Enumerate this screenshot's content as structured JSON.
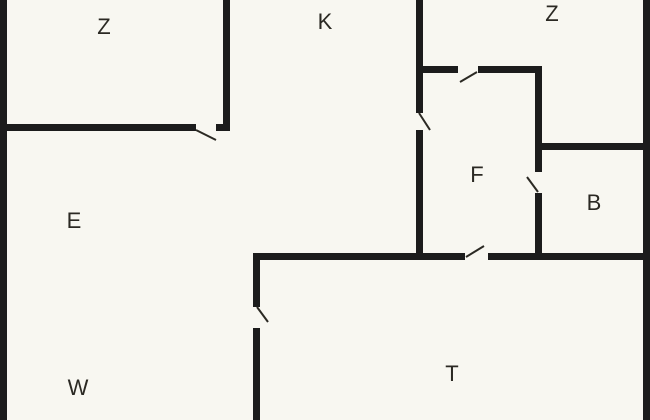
{
  "floorplan": {
    "canvas": {
      "width": 650,
      "height": 420,
      "background": "#f8f7f1"
    },
    "style": {
      "wall_color": "#1c1c1c",
      "wall_thickness": 7,
      "door_line_color": "#2b2923",
      "door_line_width": 2,
      "label_color": "#2b2923",
      "label_font_size": 22
    },
    "room_labels": [
      {
        "id": "room-z-left",
        "text": "Z",
        "cx": 104,
        "cy": 27
      },
      {
        "id": "room-k",
        "text": "K",
        "cx": 325,
        "cy": 22
      },
      {
        "id": "room-z-right",
        "text": "Z",
        "cx": 552,
        "cy": 14
      },
      {
        "id": "room-e",
        "text": "E",
        "cx": 74,
        "cy": 221
      },
      {
        "id": "room-f",
        "text": "F",
        "cx": 477,
        "cy": 175
      },
      {
        "id": "room-b",
        "text": "B",
        "cx": 594,
        "cy": 203
      },
      {
        "id": "room-w",
        "text": "W",
        "cx": 78,
        "cy": 388
      },
      {
        "id": "room-t",
        "text": "T",
        "cx": 452,
        "cy": 374
      }
    ],
    "walls": [
      {
        "name": "outer-wall-left",
        "x": 0,
        "y": 0,
        "w": 7,
        "h": 420
      },
      {
        "name": "outer-wall-right",
        "x": 643,
        "y": 0,
        "w": 7,
        "h": 420
      },
      {
        "name": "wall-z-left-k",
        "x": 223,
        "y": 0,
        "w": 7,
        "h": 131
      },
      {
        "name": "wall-z-left-bottom-a",
        "x": 0,
        "y": 124,
        "w": 196,
        "h": 7
      },
      {
        "name": "wall-z-left-bottom-b",
        "x": 216,
        "y": 124,
        "w": 14,
        "h": 7
      },
      {
        "name": "wall-k-f-upper",
        "x": 416,
        "y": 0,
        "w": 7,
        "h": 113
      },
      {
        "name": "wall-k-f-lower",
        "x": 416,
        "y": 130,
        "w": 7,
        "h": 130
      },
      {
        "name": "wall-f-top-a",
        "x": 416,
        "y": 66,
        "w": 42,
        "h": 7
      },
      {
        "name": "wall-f-top-b",
        "x": 478,
        "y": 66,
        "w": 64,
        "h": 7
      },
      {
        "name": "wall-f-b-upper",
        "x": 535,
        "y": 66,
        "w": 7,
        "h": 106
      },
      {
        "name": "wall-f-b-lower",
        "x": 535,
        "y": 193,
        "w": 7,
        "h": 67
      },
      {
        "name": "wall-b-top",
        "x": 535,
        "y": 143,
        "w": 115,
        "h": 7
      },
      {
        "name": "wall-main-horizontal-a",
        "x": 253,
        "y": 253,
        "w": 212,
        "h": 7
      },
      {
        "name": "wall-main-horizontal-b",
        "x": 488,
        "y": 253,
        "w": 162,
        "h": 7
      },
      {
        "name": "wall-w-t-upper",
        "x": 253,
        "y": 253,
        "w": 7,
        "h": 54
      },
      {
        "name": "wall-w-t-lower",
        "x": 253,
        "y": 328,
        "w": 7,
        "h": 92
      }
    ],
    "doors": [
      {
        "name": "door-leaf-z-left",
        "x1": 196,
        "y1": 130,
        "x2": 216,
        "y2": 140
      },
      {
        "name": "door-leaf-k-f",
        "x1": 419,
        "y1": 113,
        "x2": 430,
        "y2": 130
      },
      {
        "name": "door-leaf-f-top",
        "x1": 477,
        "y1": 72,
        "x2": 460,
        "y2": 82
      },
      {
        "name": "door-leaf-f-b",
        "x1": 527,
        "y1": 177,
        "x2": 538,
        "y2": 192
      },
      {
        "name": "door-leaf-main",
        "x1": 466,
        "y1": 257,
        "x2": 484,
        "y2": 246
      },
      {
        "name": "door-leaf-w-t",
        "x1": 257,
        "y1": 307,
        "x2": 268,
        "y2": 322
      }
    ]
  }
}
